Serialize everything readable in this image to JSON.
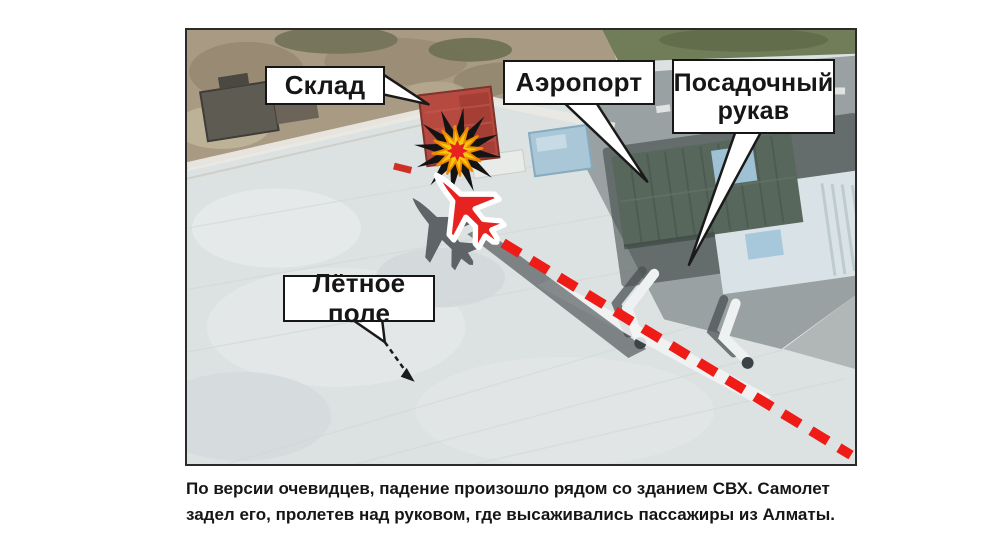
{
  "map": {
    "callouts": {
      "sklad": {
        "label": "Склад"
      },
      "airport": {
        "label": "Аэропорт"
      },
      "jet_bridge": {
        "label": "Посадочный рукав"
      },
      "airfield": {
        "label": "Лётное поле"
      }
    },
    "markers": {
      "explosion": "explosion-burst",
      "airplane": "crashed-airplane",
      "trajectory": "flight-path-dashed-line"
    },
    "colors": {
      "trajectory_red": "#ee1b17",
      "airplane_red": "#e62320",
      "explosion_black": "#141414",
      "explosion_yellow": "#f6c80e",
      "explosion_core_red": "#e8221f",
      "callout_border": "#161616"
    }
  },
  "caption": {
    "lines": [
      "По версии очевидцев, падение произошло рядом со зданием СВХ. Самолет",
      "задел его, пролетев над руковом, где высаживались пассажиры из Алматы."
    ]
  }
}
